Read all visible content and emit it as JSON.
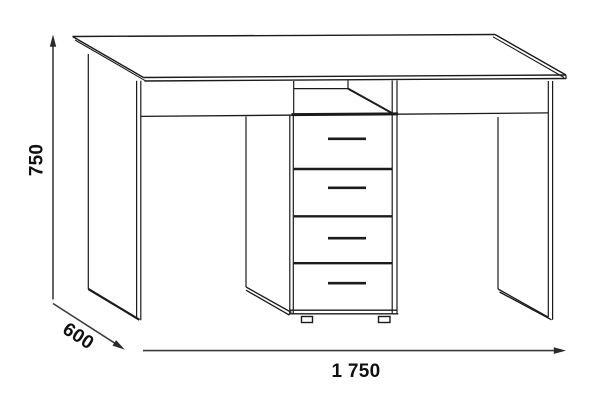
{
  "drawing": {
    "kind": "furniture-dimension-diagram",
    "subject": "desk-with-drawer-pedestal",
    "dimensions": {
      "height": "750",
      "depth": "600",
      "width": "1 750"
    },
    "furniture": {
      "drawer_count": 4,
      "open_niche_count": 1,
      "feet_count": 2
    },
    "colors": {
      "background": "#ffffff",
      "outline": "#1b1b1b",
      "dimension_line": "#3d3d3d",
      "label_text": "#101010"
    }
  }
}
